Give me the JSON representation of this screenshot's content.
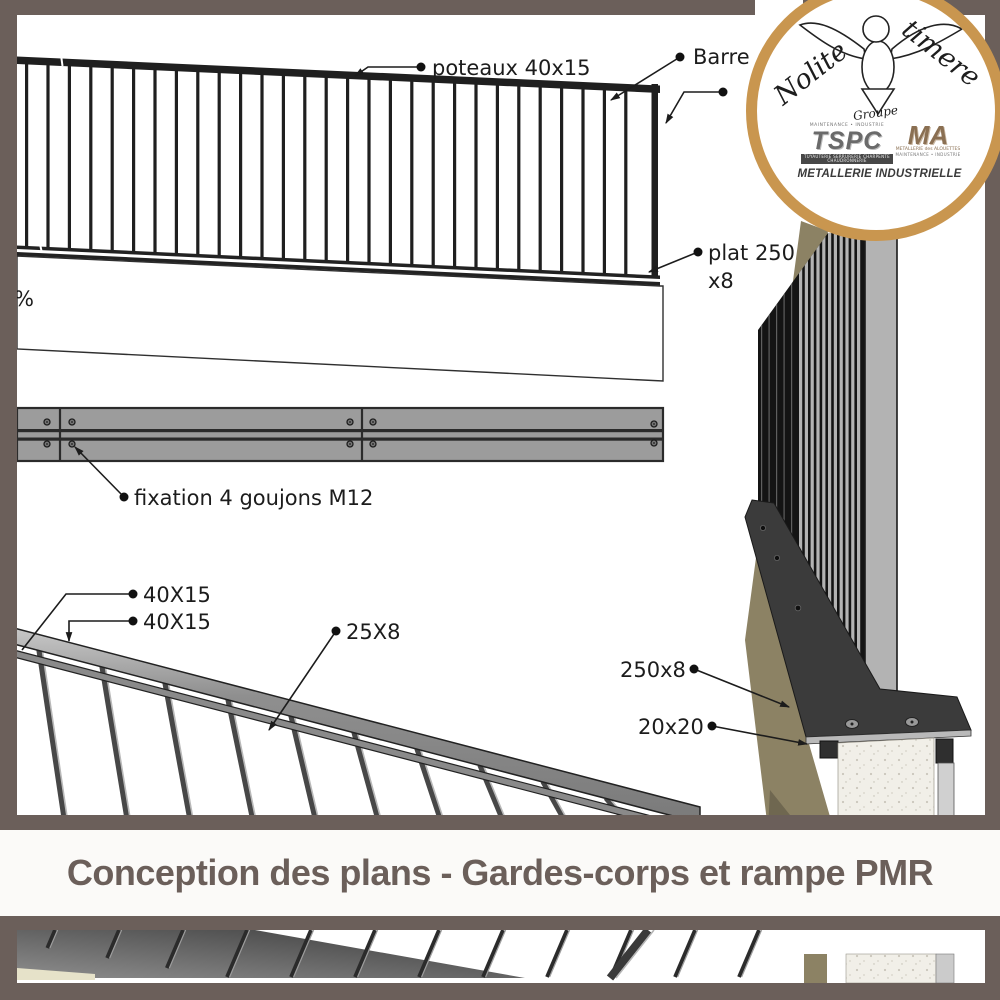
{
  "frame": {
    "color": "#6b5f5a"
  },
  "title_band": {
    "text": "Conception des plans - Gardes-corps et rampe PMR"
  },
  "logo": {
    "script_left": "Nolite",
    "script_right": "timere",
    "script_group": "Groupe",
    "tspc_top": "MAINTENANCE • INDUSTRIE",
    "tspc_name": "TSPC",
    "tspc_bottom": "TUYAUTERIE SERRURERIE CHARPENTE CHAUDRONNERIE",
    "ma_name": "MA",
    "ma_sub1": "METALLERIE des ALOUETTES",
    "ma_sub2": "MAINTENANCE • INDUSTRIE",
    "tagline": "METALLERIE INDUSTRIELLE"
  },
  "annotations": {
    "poteaux": "poteaux 40x15",
    "barre": "Barre",
    "plat1": "plat 250",
    "plat2": "x8",
    "slope": "%",
    "fixation": "fixation 4 goujons M12",
    "rail1": "40X15",
    "rail2": "40X15",
    "subrail": "25X8",
    "plate": "250x8",
    "square_bar": "20x20"
  }
}
